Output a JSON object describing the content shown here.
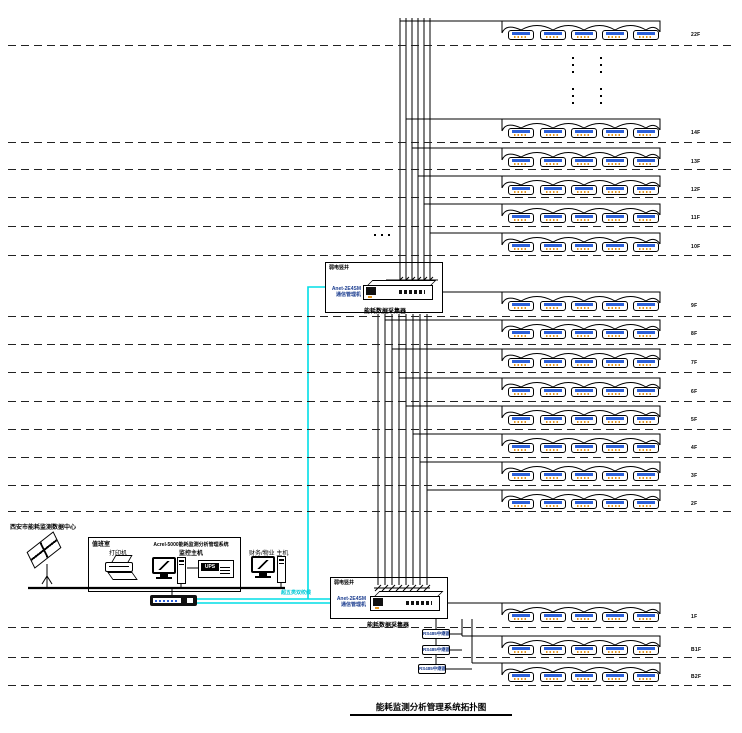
{
  "title": "能耗监测分析管理系统拓扑图",
  "data_center": {
    "label": "西安市能耗监测数据中心"
  },
  "duty_room": {
    "room_label": "值班室",
    "printer_label": "打印机",
    "host_label_line1": "Acrel-5000能耗监测分析管理系统",
    "host_label_line2": "监控主机",
    "ups_label": "UPS"
  },
  "finance_host": {
    "label": "财务/物业 主机"
  },
  "network": {
    "cable_label": "超五类双绞线"
  },
  "collectors": {
    "upper": {
      "room_label": "弱电竖井",
      "device_label_line1": "Anet-2E4SM",
      "device_label_line2": "通信管理机",
      "caption": "能耗数据采集器"
    },
    "lower": {
      "room_label": "弱电竖井",
      "device_label_line1": "Anet-2E4SM",
      "device_label_line2": "通信管理机",
      "caption": "能耗数据采集器"
    }
  },
  "repeaters": [
    "RS485中继器",
    "RS485中继器",
    "RS485中继器"
  ],
  "floors": [
    {
      "label": "22F",
      "meters": 5
    },
    {
      "label": "14F",
      "meters": 5
    },
    {
      "label": "13F",
      "meters": 5
    },
    {
      "label": "12F",
      "meters": 5
    },
    {
      "label": "11F",
      "meters": 5
    },
    {
      "label": "10F",
      "meters": 5
    },
    {
      "label": "9F",
      "meters": 5
    },
    {
      "label": "8F",
      "meters": 5
    },
    {
      "label": "7F",
      "meters": 5
    },
    {
      "label": "6F",
      "meters": 5
    },
    {
      "label": "5F",
      "meters": 5
    },
    {
      "label": "4F",
      "meters": 5
    },
    {
      "label": "3F",
      "meters": 5
    },
    {
      "label": "2F",
      "meters": 5
    },
    {
      "label": "1F",
      "meters": 5
    },
    {
      "label": "B1F",
      "meters": 5
    },
    {
      "label": "B2F",
      "meters": 5
    }
  ],
  "colors": {
    "cyan_cable": "#00DDE6",
    "blue_text": "#1A3C8F",
    "meter_display": "#2B5FD9",
    "meter_dot": "#E39520"
  }
}
